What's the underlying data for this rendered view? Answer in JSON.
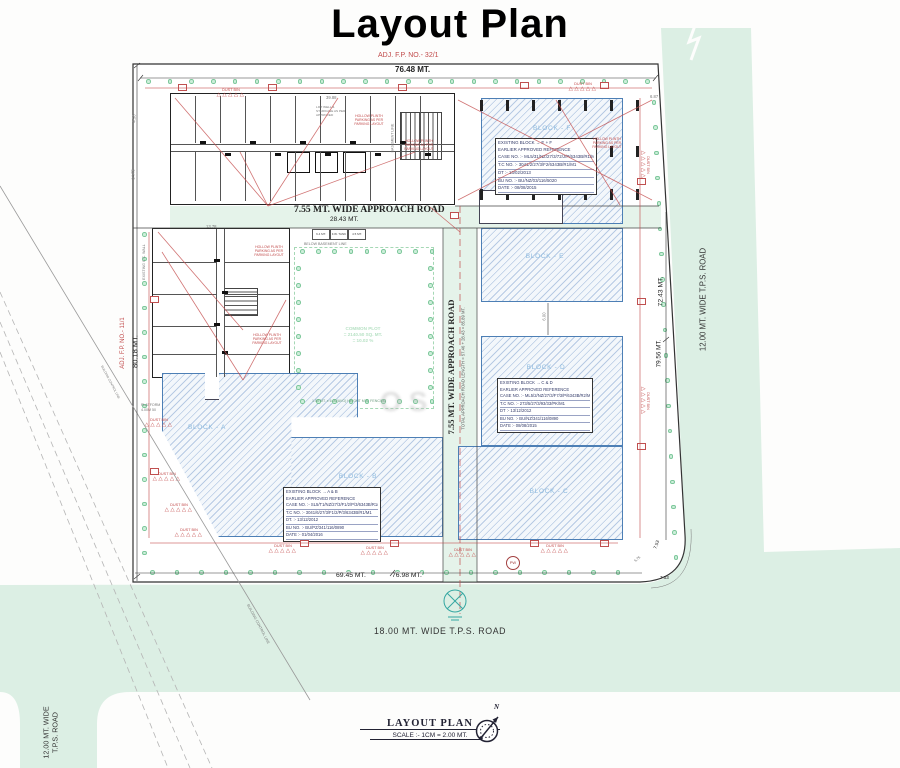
{
  "title": "Layout Plan",
  "annotations": {
    "adj_fp_top": "ADJ. F.P. NO.- 32/1",
    "adj_fp_left": "ADJ. F.P. NO.- 11/1",
    "parking_note": "HOLLOW PLINTH PARKING AS PER PARKING LAYOUT",
    "dust_bin": "DUST BIN",
    "dust_bin_icon": "△△△△△",
    "below_basement": "BELOW BASEMENT LINE",
    "basement_line": "BASEMENT LINE",
    "existing_wall": "EXISTING C.C. WALL",
    "control_line": "BUILDING CONTROL LINE",
    "fence_note": "1.50 MT. x 6.00(AVG) HEIGHT M.S. FENCING",
    "platform": "PLATFORM 4.00M 50",
    "lift_note": "LIFT WELL & STAIRCASE AS PER APPROVED",
    "pw": "PW"
  },
  "dimensions": {
    "top": "76.48 MT.",
    "left": "80.18 MT.",
    "approach_len": "28.43 MT.",
    "right_upper": "72.43 MT.",
    "right_lower": "79.56 MT.",
    "bottom_a": "69.45 MT.",
    "bottom_b": "76.98 MT.",
    "corner_a": "7.53",
    "corner_b": "7.53",
    "corner_c": "5.75",
    "d_3988": "39.88",
    "d_1378": "13.78",
    "d_450": "4.50",
    "d_1475": "14.75",
    "d_687": "6.87",
    "d_600": "6.00"
  },
  "roads": {
    "approach_h": "7.55 MT. WIDE APPROACH ROAD",
    "approach_v": "7.55 MT. WIDE APPROACH ROAD",
    "approach_total": "TOTAL APPROACH ROAD LENGTH = 57.46 + 28.43 = 85.89 MT.",
    "tps_right": "12.00 MT. WIDE T.P.S. ROAD",
    "tps_bottom": "18.00 MT. WIDE T.P.S. ROAD",
    "tps_left_1": "12.00 MT. WIDE",
    "tps_left_2": "T.P.S. ROAD"
  },
  "blocks": {
    "a": "BLOCK - A",
    "b": "BLOCK - B",
    "c": "BLOCK - C",
    "d": "BLOCK - D",
    "e": "BLOCK - E",
    "f": "BLOCK - F"
  },
  "tables": {
    "ef": [
      "EXISTING BLOCK → E + F",
      "EARLIER APPROVED REFERENCE",
      "CASE NO. :- ML5/31/NZ/27/3/72/J/P/6343B/R1/M1",
      "T.C NO. :- 3041/2/27/3/F2/6343B/R1/M1",
      "DT :- 13/02/2013",
      "BU NO. :- BU/NZ/03/116/5020",
      "DATE :- 08/08/2015"
    ],
    "cd": [
      "EXISTING BLOCK → C & D",
      "EARLIER APPROVED REFERENCE",
      "CASE NO. :- ML5/2/NZ/27/3/F7/3/P/6343B/R2/M1",
      "T.C NO. :- 273/5/27/3/93/33/PK/M1",
      "DT :- 13/12/2012",
      "BU NO. :- BU/NZ/341/116/0890",
      "DATE :- 08/08/2015"
    ],
    "ab": [
      "EXISTING BLOCK → A & B",
      "EARLIER APPROVED REFERENCE",
      "CASE NO. :- SL5/T1/NZ/27/3/F1/2/P/3/6343B/R1/M1",
      "T.C NO. :- 3041/6/27/3/F1/2/P/3/6343B/R1/M1",
      "DT. :- 13/12/2012",
      "BU NO. :- BU/PZ/341/116/0890",
      "DATE :- 01/04/2016"
    ]
  },
  "common_plot": [
    "COMMON PLOT",
    "= 2140.50 SQ. MT.",
    "= 10.02 %"
  ],
  "tank_boxes": [
    "6.4 MT.",
    "F.W. TANK",
    "4.5 MT."
  ],
  "footer": {
    "title": "LAYOUT PLAN",
    "scale": "SCALE :- 1CM = 2.00 MT.",
    "north": "N"
  },
  "watermark": "OS"
}
